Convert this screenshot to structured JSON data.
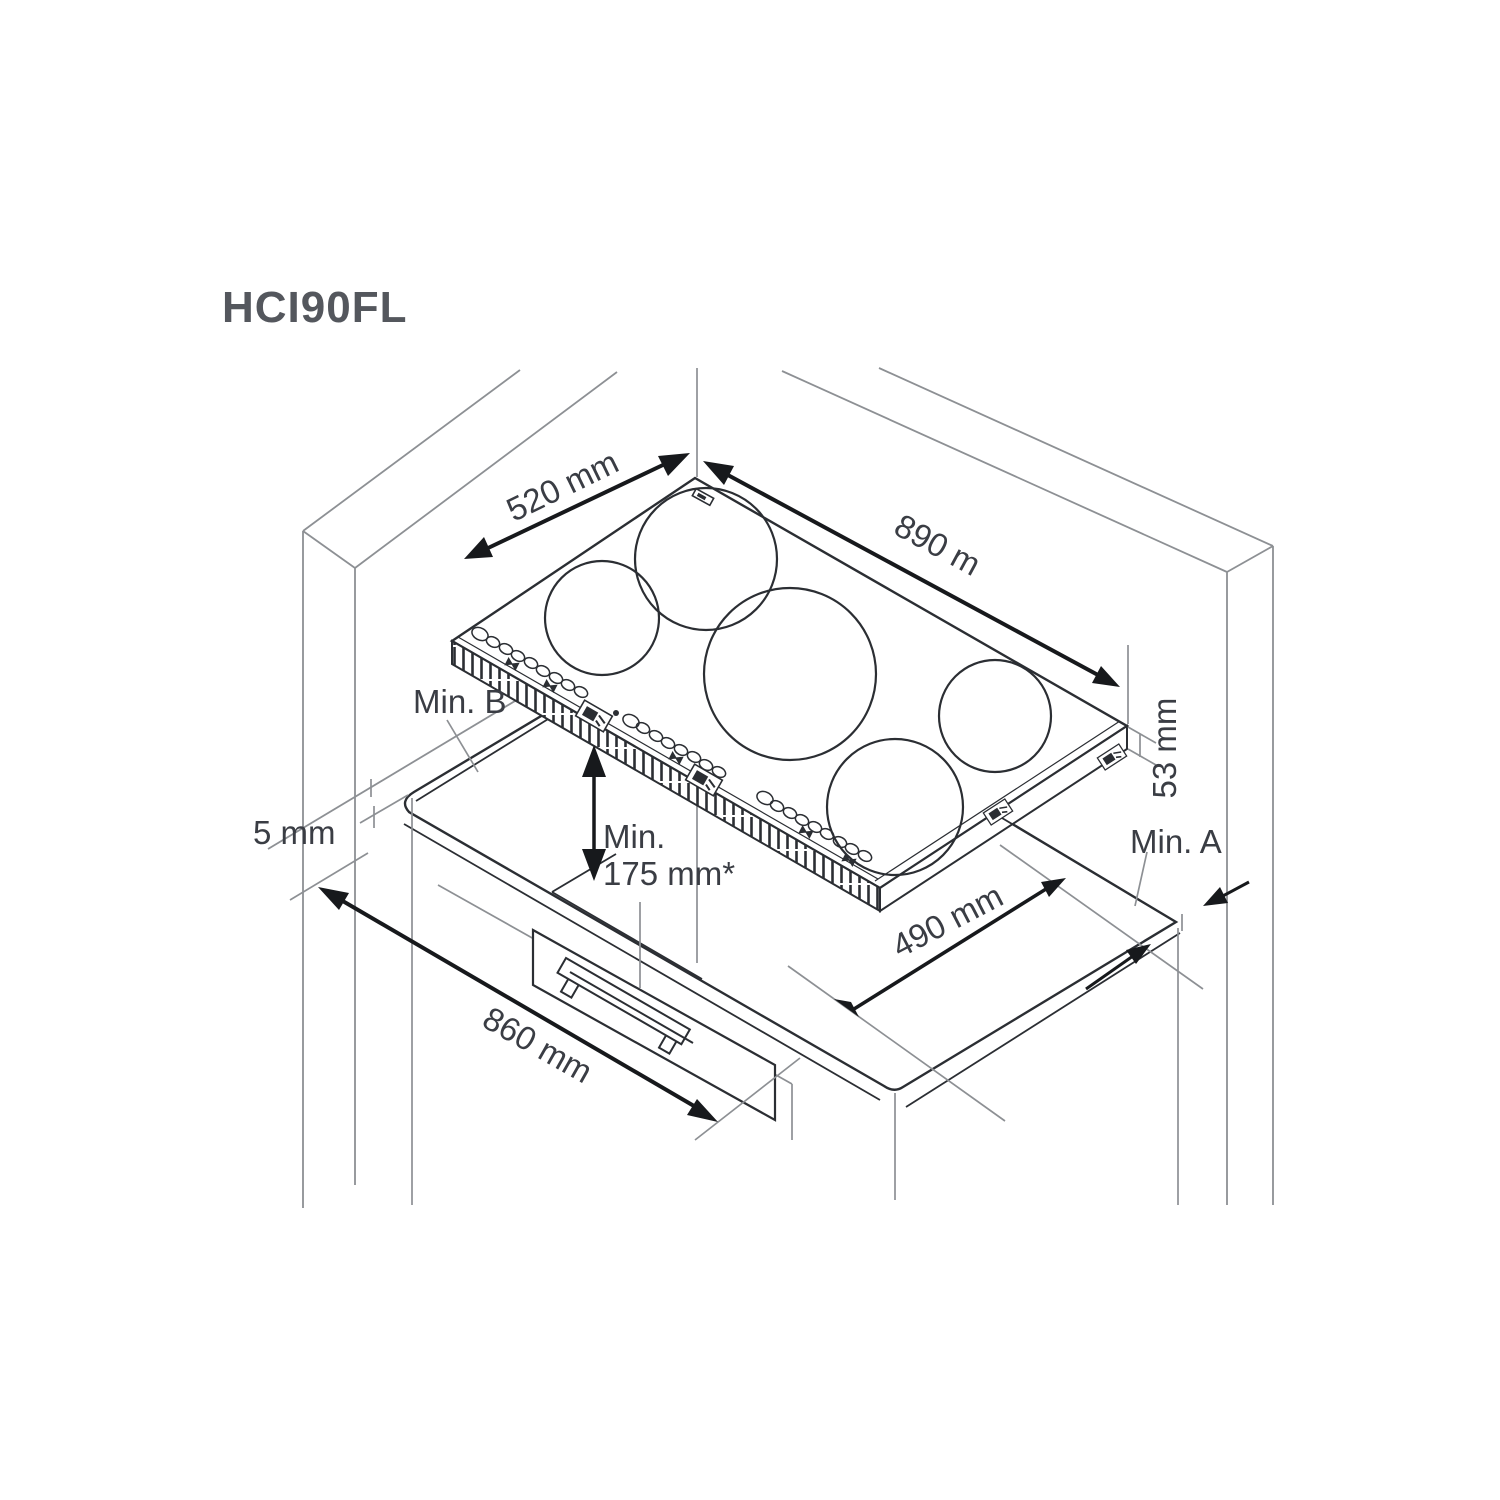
{
  "title": "HCI90FL",
  "labels": {
    "dim_520": "520 mm",
    "dim_890": "890 m",
    "dim_53": "53 mm",
    "min_b": "Min. B",
    "min_clearance_line1": "Min.",
    "min_clearance_line2": "175 mm*",
    "dim_5": "5 mm",
    "dim_860": "860 mm",
    "dim_490": "490 mm",
    "min_a": "Min. A"
  },
  "colors": {
    "ink": "#2b2e33",
    "structure_gray": "#8d9094",
    "dimension_black": "#17191c",
    "text": "#3a3d44",
    "background": "#ffffff"
  },
  "diagram": {
    "type": "isometric installation drawing",
    "subject": "built-in induction hob with 5 cooking zones above cabinet with drawer",
    "dimensions_mm": {
      "hob_depth": 520,
      "hob_width": 890,
      "hob_height": 53,
      "wall_side_gap": 5,
      "cabinet_width": 860,
      "cutout_depth": 490,
      "min_clearance_below": "175 mm*",
      "side_clearance_right": "Min. A",
      "rear_clearance": "Min. B"
    }
  }
}
